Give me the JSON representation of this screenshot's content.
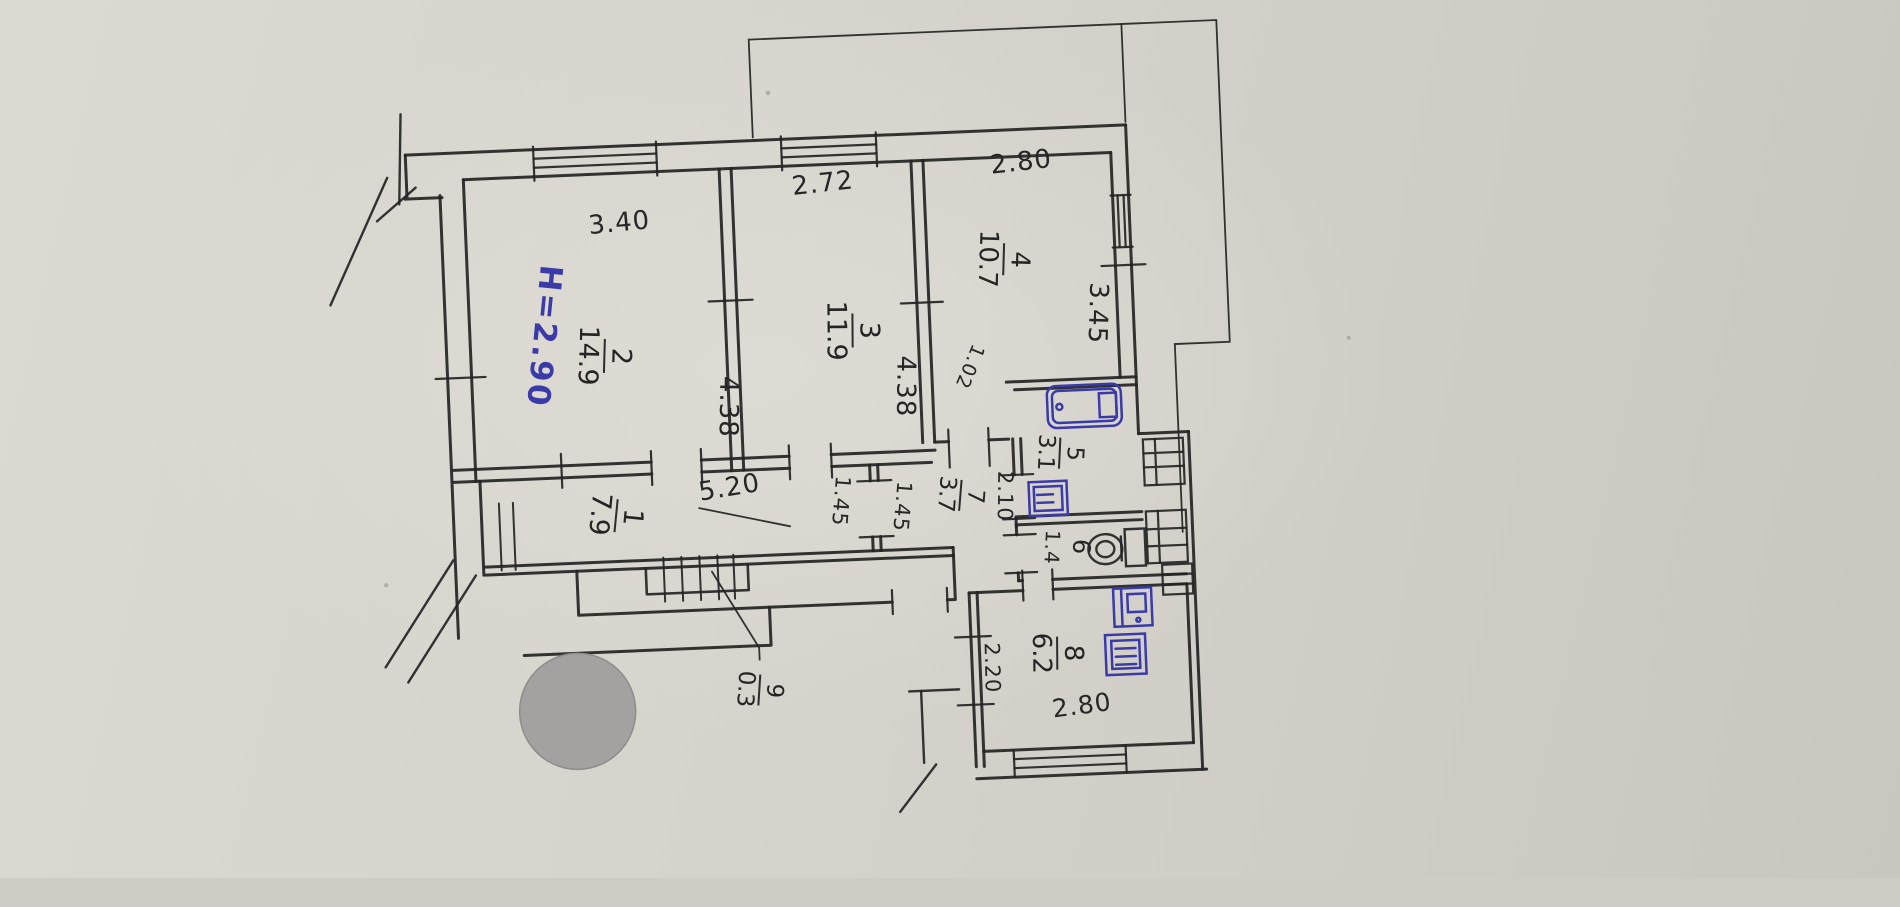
{
  "document": {
    "kind": "scanned handwritten apartment floor plan",
    "paper_color": "#d7d4cd",
    "ink_color": "#242424",
    "blue_ink_color": "#3a3aa8"
  },
  "annotations": {
    "ceiling_height": "H=2.90"
  },
  "rooms": [
    {
      "number": "1",
      "area": "7.9"
    },
    {
      "number": "2",
      "area": "14.9"
    },
    {
      "number": "3",
      "area": "11.9"
    },
    {
      "number": "4",
      "area": "10.7"
    },
    {
      "number": "5",
      "area": "3.1"
    },
    {
      "number": "6"
    },
    {
      "number": "7",
      "area": "3.7"
    },
    {
      "number": "8",
      "area": "6.2"
    },
    {
      "number": "9",
      "area": "0.3"
    }
  ],
  "dimensions": [
    {
      "value": "3.40"
    },
    {
      "value": "2.72"
    },
    {
      "value": "2.80"
    },
    {
      "value": "3.45"
    },
    {
      "value": "4.38"
    },
    {
      "value": "4.38"
    },
    {
      "value": "1.02"
    },
    {
      "value": "5.20"
    },
    {
      "value": "1.45"
    },
    {
      "value": "1.45"
    },
    {
      "value": "2.10"
    },
    {
      "value": "1.4"
    },
    {
      "value": "2.20"
    },
    {
      "value": "2.80"
    }
  ]
}
